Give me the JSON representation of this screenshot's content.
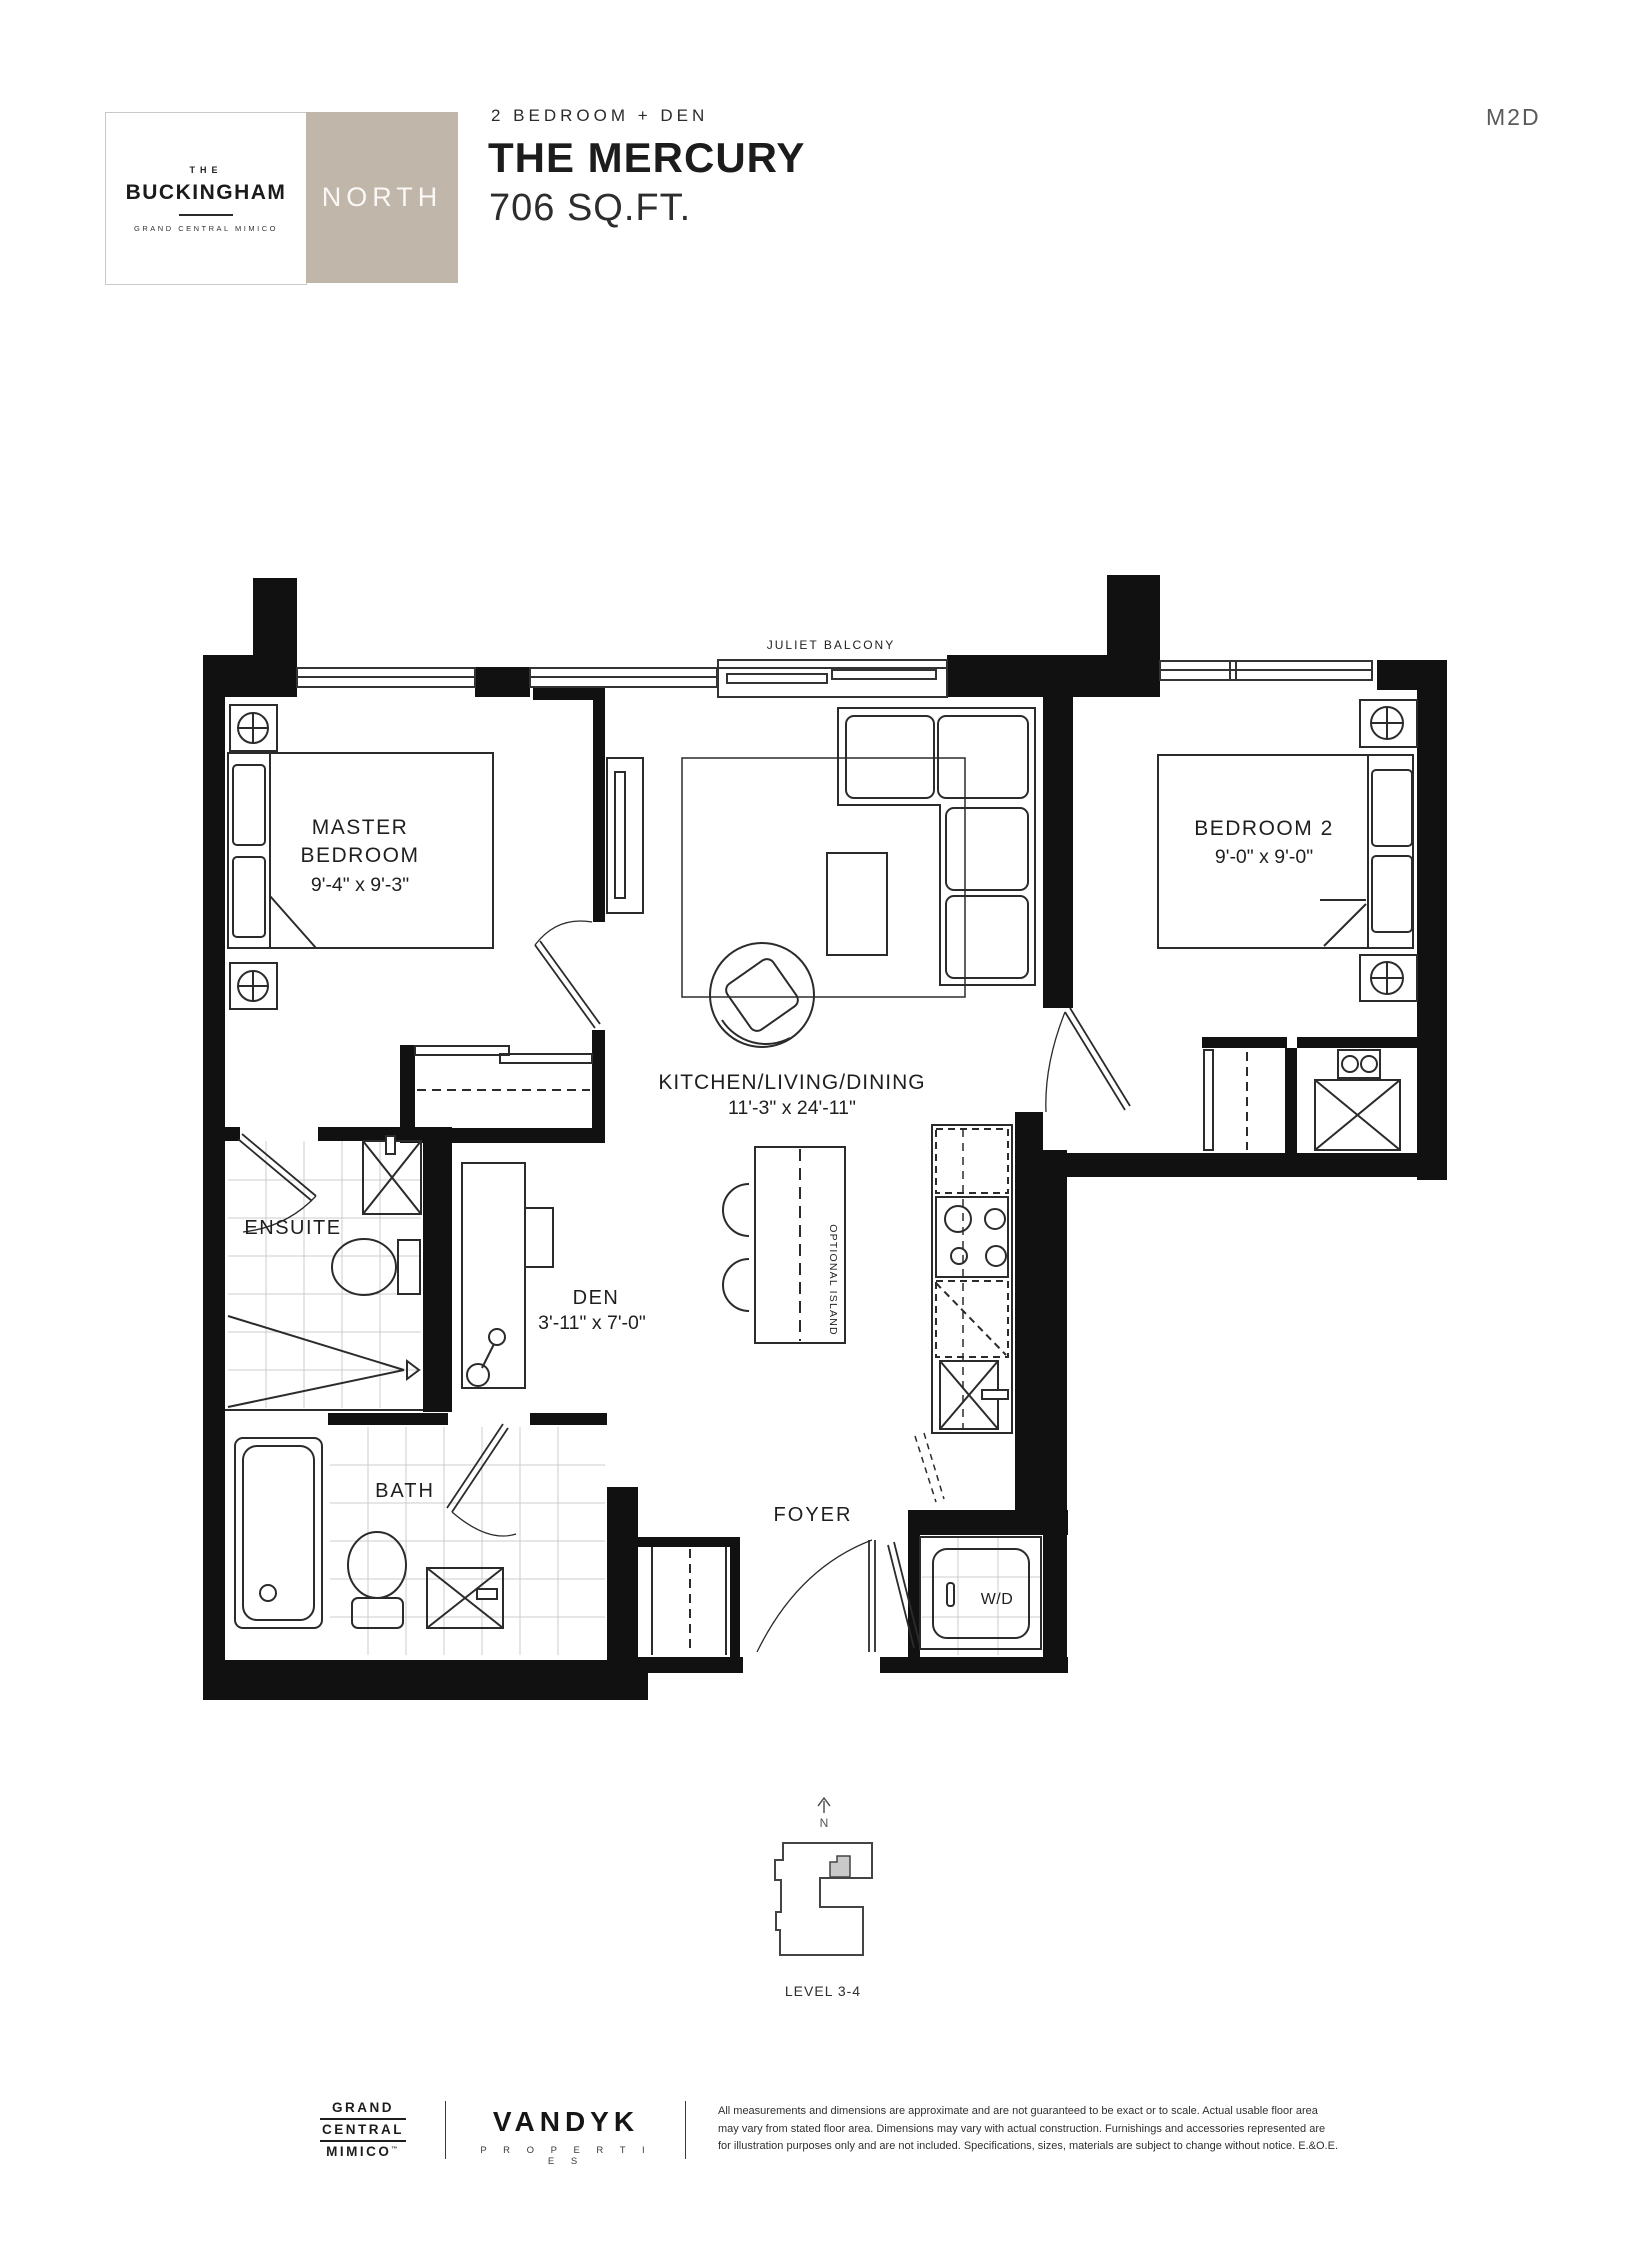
{
  "colors": {
    "badge_bg": "#c0b6aa",
    "wall": "#111111",
    "keyplan_unit": "#c9c9c9"
  },
  "header": {
    "brand_small": "THE",
    "brand_name": "BUCKINGHAM",
    "brand_tagline": "GRAND CENTRAL MIMICO",
    "tower_badge": "NORTH",
    "unit_type": "2 BEDROOM + DEN",
    "unit_name": "THE MERCURY",
    "unit_area": "706 SQ.FT.",
    "unit_code": "M2D"
  },
  "plan": {
    "balcony": "JULIET BALCONY",
    "master_line1": "MASTER",
    "master_line2": "BEDROOM",
    "master_dims": "9'-4\" x 9'-3\"",
    "bedroom2": "BEDROOM 2",
    "bedroom2_dims": "9'-0\" x 9'-0\"",
    "kld": "KITCHEN/LIVING/DINING",
    "kld_dims": "11'-3\" x 24'-11\"",
    "ensuite": "ENSUITE",
    "den": "DEN",
    "den_dims": "3'-11\" x 7'-0\"",
    "bath": "BATH",
    "foyer": "FOYER",
    "wd": "W/D",
    "optional_island": "OPTIONAL ISLAND",
    "north_letter": "N",
    "level": "LEVEL 3-4"
  },
  "footer": {
    "brand_lines": [
      "GRAND",
      "CENTRAL",
      "MIMICO"
    ],
    "brand_tm": "™",
    "developer": "VANDYK",
    "developer_sub": "P R O P E R T I E S",
    "disclaimer": [
      "All measurements and dimensions are approximate and are not guaranteed to be exact or to scale. Actual usable floor area",
      "may vary from stated floor area. Dimensions may vary with actual construction. Furnishings and accessories represented are",
      "for illustration purposes only and are not included. Specifications, sizes, materials are subject to change without notice. E.&O.E."
    ]
  }
}
